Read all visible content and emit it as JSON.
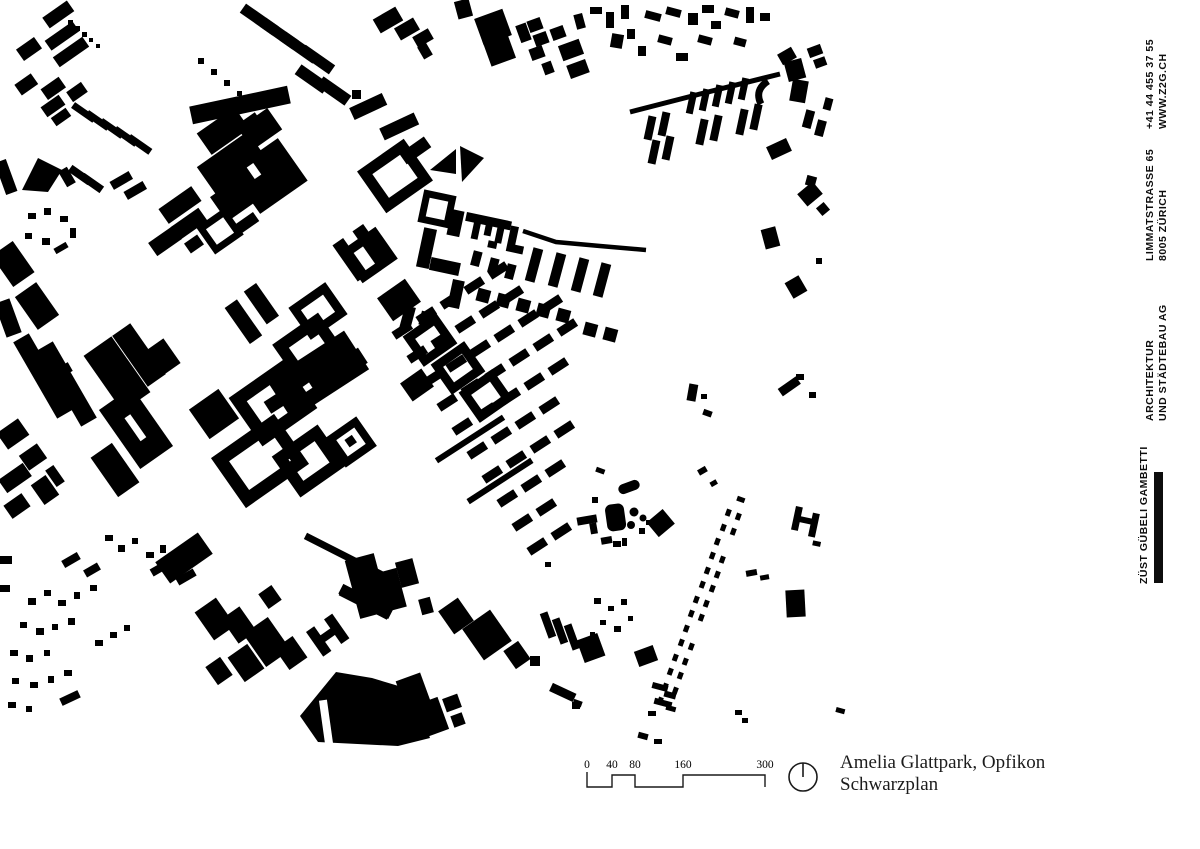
{
  "page": {
    "background": "#ffffff",
    "kind": "architectural figure-ground plan sheet"
  },
  "map": {
    "colors": {
      "building": "#000000",
      "highlight": "#e2322a",
      "background": "#ffffff"
    },
    "highlight_building": "project site (red comb-shaped building)"
  },
  "legend": {
    "scalebar": {
      "labels": [
        "0",
        "40",
        "80",
        "160",
        "300"
      ]
    },
    "north_icon": "north-indicator-circle",
    "title_line1": "Amelia Glattpark, Opfikon",
    "title_line2": "Schwarzplan"
  },
  "sidebar": {
    "contact": {
      "line1": "+41 44 455 37 55",
      "line2": "WWW.Z2G.CH"
    },
    "address": {
      "line1": "LIMMATSTRASSE 65",
      "line2": "8005 ZÜRICH"
    },
    "firm_type": {
      "line1": "ARCHITEKTUR",
      "line2": "UND STÄDTEBAU AG"
    },
    "firm_name": {
      "line1": "ZÜST GÜBELI GAMBETTI"
    }
  }
}
